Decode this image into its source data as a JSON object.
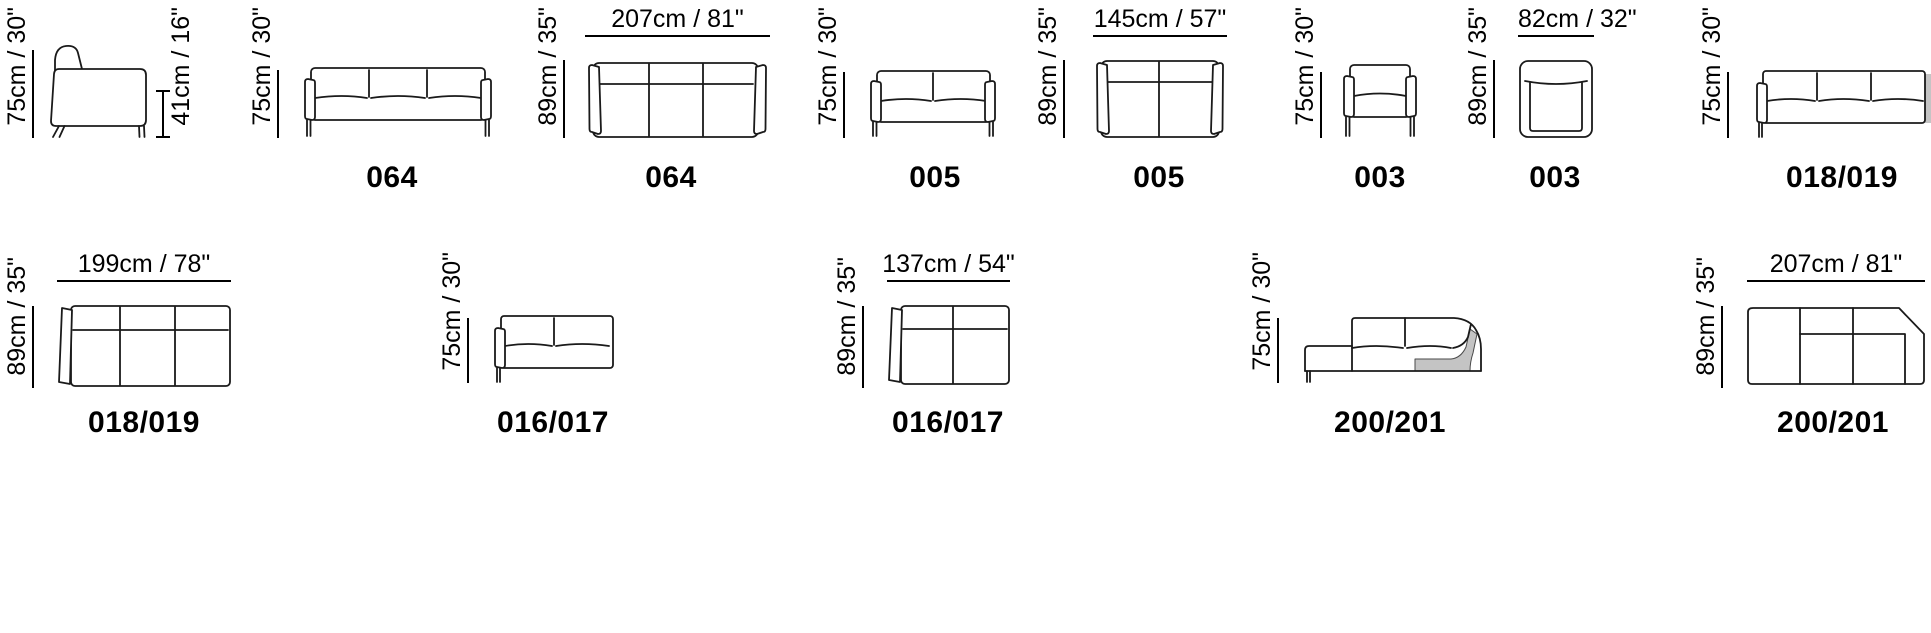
{
  "canvas": {
    "background": "#ffffff",
    "line_color": "#1a1a1a",
    "shade_color": "#c4c4c4"
  },
  "figures": [
    {
      "id": "side-view",
      "view": "side",
      "model": "",
      "dim_height": "75cm / 30\"",
      "dim_seat_height": "41cm / 16\""
    },
    {
      "id": "064-front",
      "view": "front",
      "model": "064",
      "dim_height": "75cm / 30\""
    },
    {
      "id": "064-top",
      "view": "top",
      "model": "064",
      "dim_depth": "89cm / 35\"",
      "dim_width": "207cm / 81\""
    },
    {
      "id": "005-front",
      "view": "front",
      "model": "005",
      "dim_height": "75cm / 30\""
    },
    {
      "id": "005-top",
      "view": "top",
      "model": "005",
      "dim_depth": "89cm / 35\"",
      "dim_width": "145cm / 57\""
    },
    {
      "id": "003-front",
      "view": "front",
      "model": "003",
      "dim_height": "75cm / 30\""
    },
    {
      "id": "003-top",
      "view": "top",
      "model": "003",
      "dim_depth": "89cm / 35\"",
      "dim_width": "82cm / 32\""
    },
    {
      "id": "018-019-front",
      "view": "front",
      "model": "018/019",
      "dim_height": "75cm / 30\""
    },
    {
      "id": "018-019-top",
      "view": "top",
      "model": "018/019",
      "dim_depth": "89cm / 35\"",
      "dim_width": "199cm / 78\""
    },
    {
      "id": "016-017-front",
      "view": "front",
      "model": "016/017",
      "dim_height": "75cm / 30\""
    },
    {
      "id": "016-017-top",
      "view": "top",
      "model": "016/017",
      "dim_depth": "89cm / 35\"",
      "dim_width": "137cm / 54\""
    },
    {
      "id": "200-201-front",
      "view": "front",
      "model": "200/201",
      "dim_height": "75cm / 30\""
    },
    {
      "id": "200-201-top",
      "view": "top",
      "model": "200/201",
      "dim_depth": "89cm / 35\"",
      "dim_width": "207cm / 81\""
    }
  ]
}
